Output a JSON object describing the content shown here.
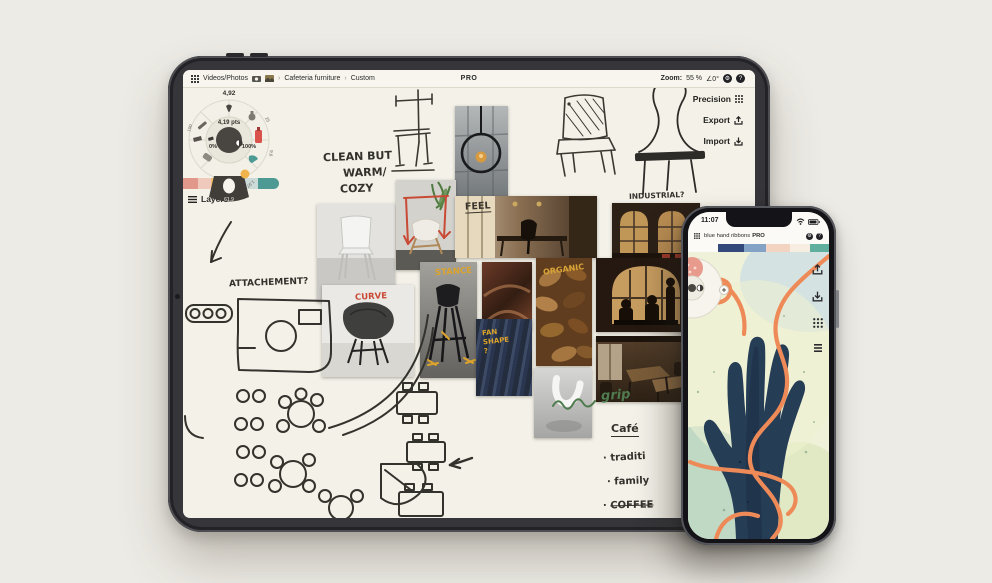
{
  "scene": {
    "bg": "#edebe5"
  },
  "ipad": {
    "toolbar": {
      "breadcrumb1": "Videos/Photos",
      "breadcrumb2": "Cafeteria furniture",
      "breadcrumb3": "Custom",
      "separator": "›",
      "pro": "PRO",
      "zoom_label": "Zoom:",
      "zoom_value": "55 %",
      "angle_value": "∠0°"
    },
    "actions": {
      "precision": "Precision",
      "export": "Export",
      "import": "Import"
    },
    "wheel": {
      "top_value": "4,92",
      "stroke": "4,19 pts",
      "min": "0%",
      "max": "100%",
      "handle": "61.9",
      "ring1": "100",
      "ring2": "25",
      "ring3": "9,6",
      "ring4": "1,97"
    },
    "palette": [
      "#e2978b",
      "#efc9bb",
      "#f2bf70",
      "#b7c6c5",
      "#cddbd8",
      "#4d9a95"
    ],
    "layers": "Layers",
    "notes": {
      "clean1": "CLEAN BUT",
      "clean2": "WARM/",
      "clean3": "COZY",
      "attachment": "ATTACHEMENT?",
      "industrial": "INDUSTRIAL?",
      "grip": "grip",
      "cafe": "Café",
      "bullet": "·",
      "cafe_item1": "traditi",
      "cafe_item2": "family",
      "cafe_item3": "COFFEE"
    },
    "photo_labels": {
      "feel": "FEEL",
      "organic": "ORGANIC",
      "stance": "STANCE",
      "curve": "CURVE",
      "fan1": "FAN",
      "fan2": "SHAPE",
      "fan3": "?"
    }
  },
  "iphone": {
    "status": {
      "time": "11:07"
    },
    "toolbar": {
      "title": "blue hand ribbons",
      "chevron": "›",
      "pro": "PRO"
    },
    "palette": [
      "#33497b",
      "#84a2c6",
      "#f3d3c2",
      "#f7eee1",
      "#5fae9e"
    ]
  }
}
